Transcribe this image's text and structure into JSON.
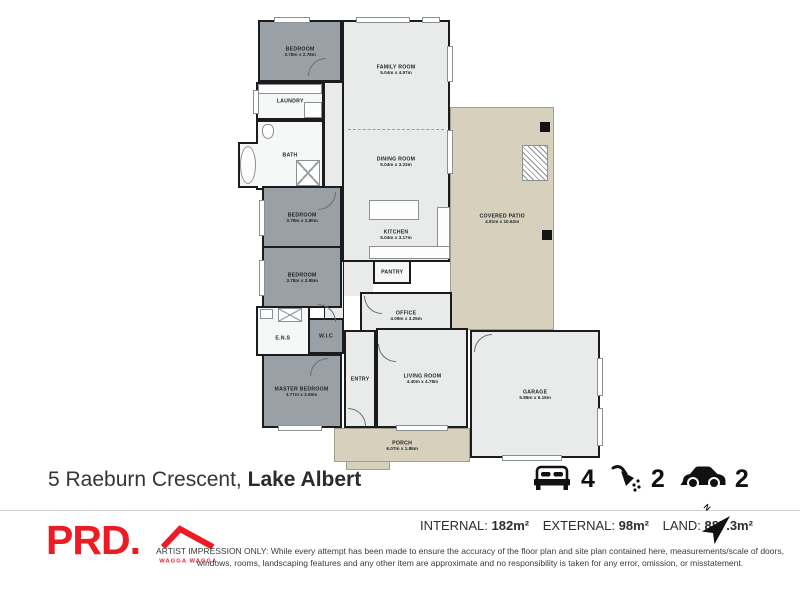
{
  "plan": {
    "rooms": [
      {
        "name": "BEDROOM",
        "dims": "3.78m x 2.78m"
      },
      {
        "name": "LAUNDRY",
        "dims": ""
      },
      {
        "name": "BATH",
        "dims": ""
      },
      {
        "name": "HALLWAY",
        "dims": ""
      },
      {
        "name": "FAMILY ROOM",
        "dims": "5.04m x 4.97m"
      },
      {
        "name": "DINING ROOM",
        "dims": "5.04m x 3.23m"
      },
      {
        "name": "KITCHEN",
        "dims": "5.04m x 3.17m"
      },
      {
        "name": "PANTRY",
        "dims": ""
      },
      {
        "name": "OFFICE",
        "dims": "4.09m x 3.25m"
      },
      {
        "name": "BEDROOM",
        "dims": "3.78m x 2.80m"
      },
      {
        "name": "BEDROOM",
        "dims": "3.78m x 2.85m"
      },
      {
        "name": "E.N.S",
        "dims": ""
      },
      {
        "name": "W.I.C",
        "dims": ""
      },
      {
        "name": "MASTER BEDROOM",
        "dims": "3.77m x 3.60m"
      },
      {
        "name": "ENTRY",
        "dims": ""
      },
      {
        "name": "LIVING ROOM",
        "dims": "4.40m x 4.78m"
      },
      {
        "name": "PORCH",
        "dims": "6.07m x 1.85m"
      },
      {
        "name": "GARAGE",
        "dims": "5.88m x 6.16m"
      },
      {
        "name": "COVERED PATIO",
        "dims": "4.91m x 10.62m"
      }
    ]
  },
  "footer": {
    "address_main": "5 Raeburn Crescent,",
    "address_suburb": "Lake Albert",
    "beds": "4",
    "baths": "2",
    "cars": "2",
    "icons": {
      "beds": "bed-icon",
      "baths": "shower-icon",
      "cars": "car-icon"
    }
  },
  "info": {
    "internal_label": "INTERNAL:",
    "internal_value": "182m²",
    "external_label": "EXTERNAL:",
    "external_value": "98m²",
    "land_label": "LAND:",
    "land_value": "887.3m²",
    "north_label": "N"
  },
  "brand": {
    "name": "PRD.",
    "location": "WAGGA WAGGA",
    "accent": "#ed1c24"
  },
  "colors": {
    "wall": "#1c1c1e",
    "room_dark": "#99a0a6",
    "room_light": "#e9ebeb",
    "outdoor_tan": "#d6d0bc"
  },
  "disclaimer": "ARTIST IMPRESSION ONLY: While every attempt has been made to ensure the accuracy of the floor plan and site plan contained here, measurements/scale of doors, windows, rooms, landscaping features and any other item are approximate and no responsibility is taken for any error, omission, or misstatement."
}
